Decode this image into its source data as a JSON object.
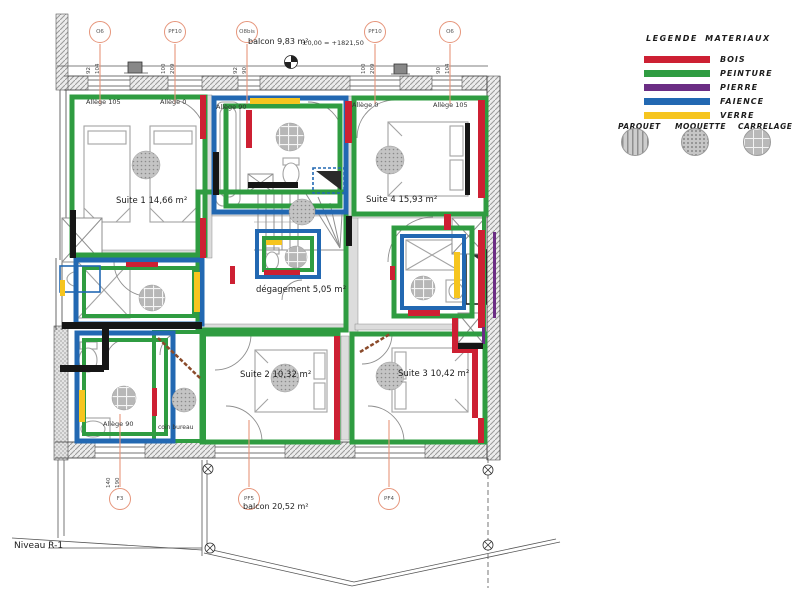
{
  "annotations": {
    "balcon_top": "balcon 9,83 m²",
    "elevation": "±0,00 = +1821,50",
    "balcon_bottom": "balcon 20,52 m²",
    "niveau": "Niveau R-1"
  },
  "legend": {
    "title": "LEGENDE MATERIAUX",
    "materials": [
      {
        "label": "BOIS",
        "color": "#cd2033"
      },
      {
        "label": "PEINTURE",
        "color": "#2f9c41"
      },
      {
        "label": "PIERRE",
        "color": "#6b2d84"
      },
      {
        "label": "FAIENCE",
        "color": "#2268b2"
      },
      {
        "label": "VERRE",
        "color": "#f6c51f"
      }
    ],
    "finishes": [
      {
        "label": "PARQUET",
        "pattern": "stripes"
      },
      {
        "label": "MOQUETTE",
        "pattern": "dots"
      },
      {
        "label": "CARRELAGE",
        "pattern": "grid"
      }
    ]
  },
  "markers": {
    "top": [
      {
        "id": "O6",
        "dims": [
          "92",
          "104"
        ]
      },
      {
        "id": "PF10",
        "dims": [
          "100",
          "209"
        ]
      },
      {
        "id": "O8bis",
        "dims": [
          "92",
          "90"
        ]
      },
      {
        "id": "PF10",
        "dims": [
          "100",
          "209"
        ]
      },
      {
        "id": "O6",
        "dims": [
          "90",
          "104"
        ]
      }
    ],
    "bottom": [
      {
        "id": "F3",
        "dims": [
          "140",
          "190"
        ]
      },
      {
        "id": "PF5",
        "dims": []
      },
      {
        "id": "PF4",
        "dims": []
      }
    ]
  },
  "rooms": [
    {
      "label": "Suite 1 14,66 m²"
    },
    {
      "label": "Suite 4 15,93 m²"
    },
    {
      "label": "dégagement 5,05 m²"
    },
    {
      "label": "Suite 2 10,32 m²"
    },
    {
      "label": "Suite 3 10,42 m²"
    },
    {
      "label": "coin bureau"
    }
  ],
  "alleges": [
    "Allège 105",
    "Allège 0",
    "Allège 90",
    "Allège 0",
    "Allège 105",
    "Allège 90"
  ]
}
